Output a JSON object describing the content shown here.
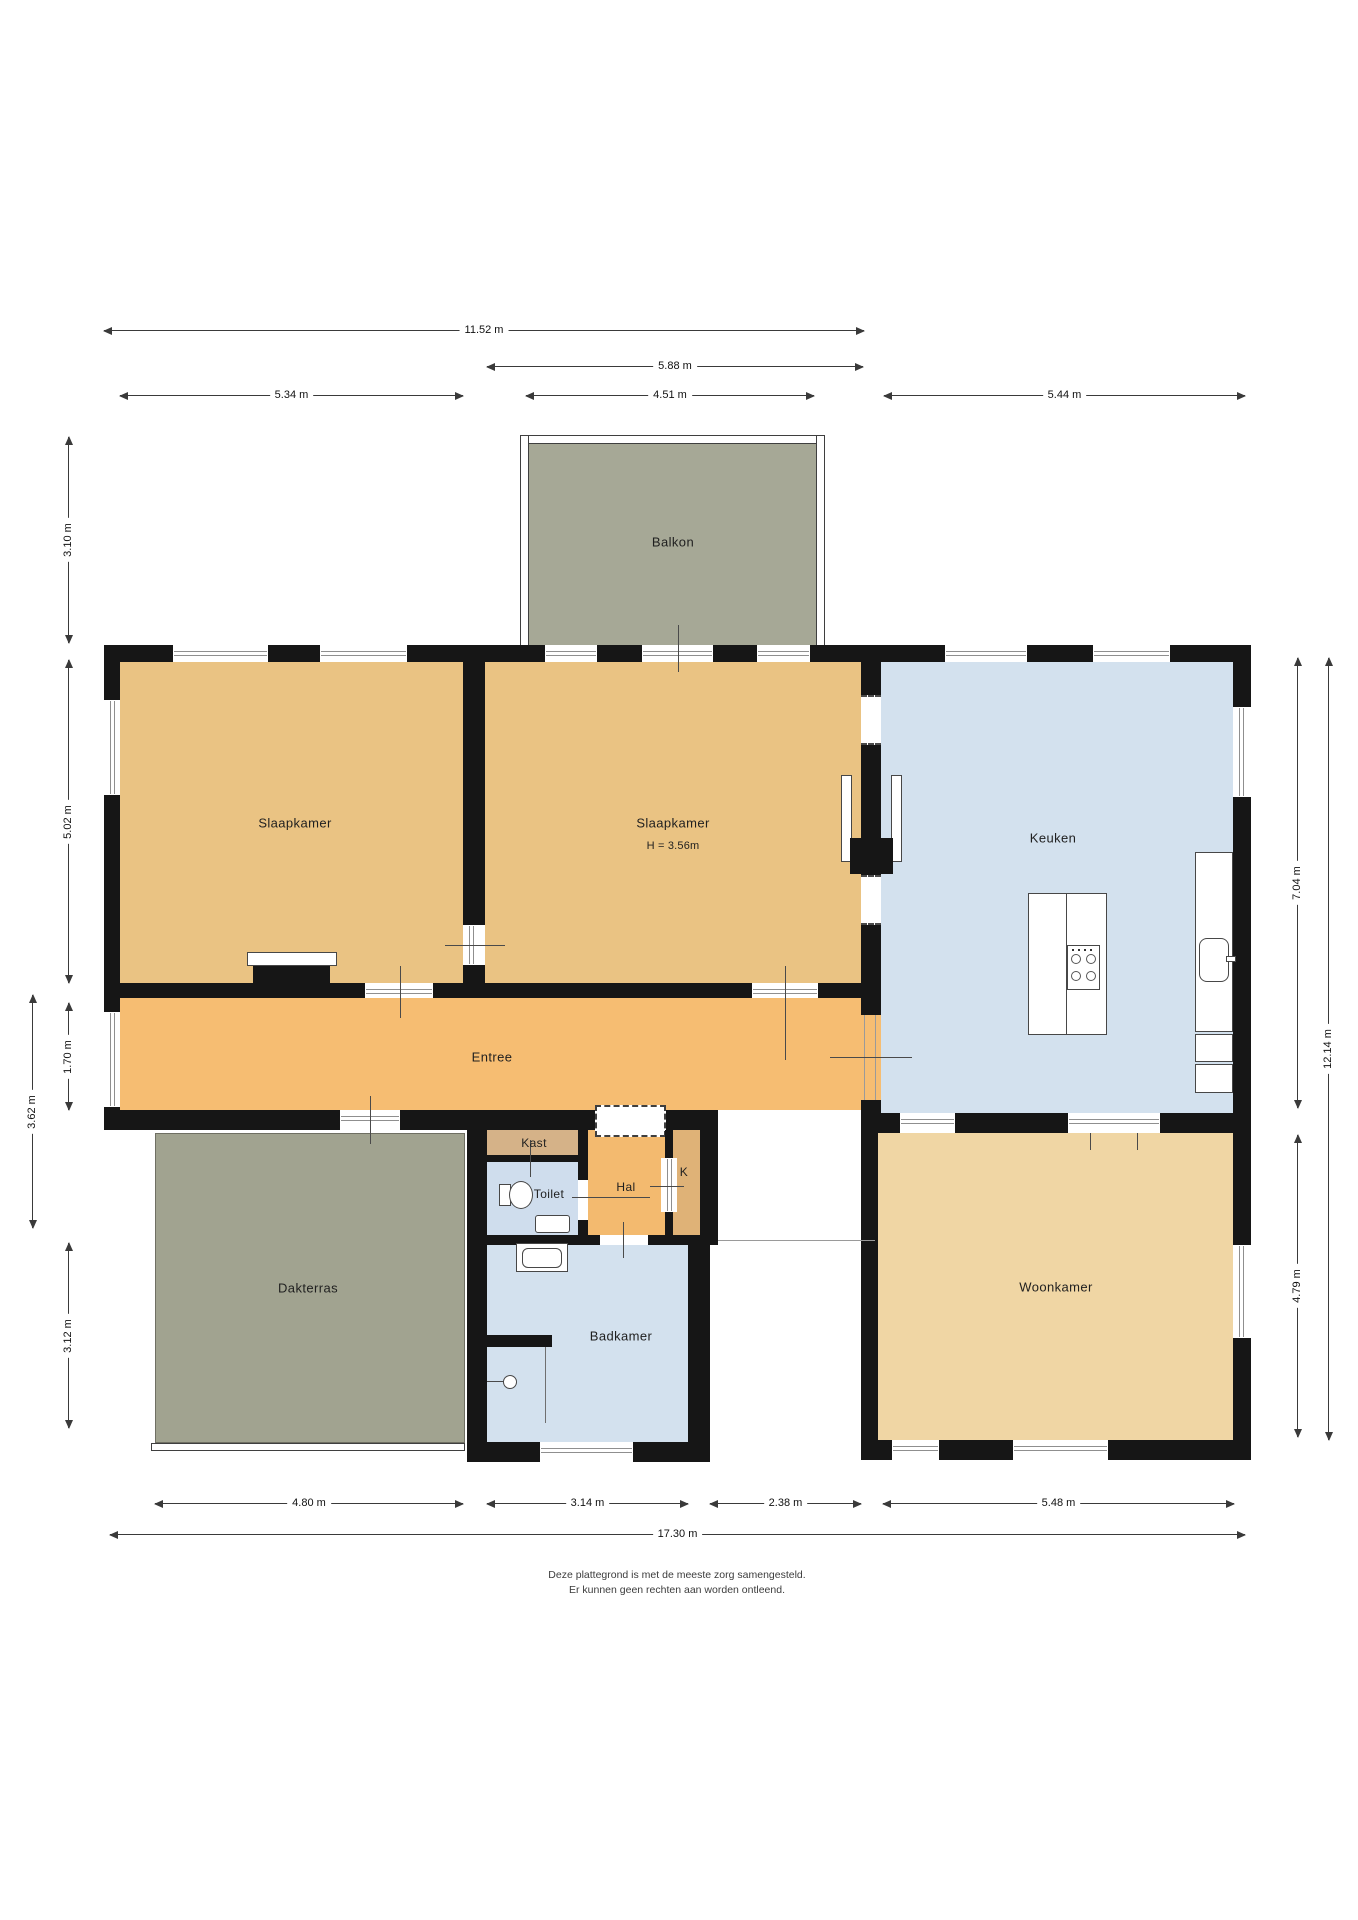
{
  "page": {
    "footer": {
      "line1": "Deze plattegrond is met de meeste zorg samengesteld.",
      "line2": "Er kunnen geen rechten aan worden ontleend."
    }
  },
  "colors": {
    "wall": "#161616",
    "window_frame": "#8f8f8f",
    "dim_line": "#3a3a3a",
    "balkon": "#a6a896",
    "dakterras": "#a1a390",
    "slaapkamer": "#eac383",
    "entree": "#f6bd72",
    "hal": "#f3ba6f",
    "kast": "#d5b288",
    "k": "#dfb277",
    "keuken": "#d3e1ee",
    "toilet": "#cfdded",
    "badkamer": "#d3e1ee",
    "woonkamer": "#f0d6a4"
  },
  "rooms": {
    "balkon": {
      "label": "Balkon"
    },
    "slaapkamer1": {
      "label": "Slaapkamer"
    },
    "slaapkamer2": {
      "label": "Slaapkamer",
      "height_note": "H = 3.56m"
    },
    "keuken": {
      "label": "Keuken"
    },
    "entree": {
      "label": "Entree"
    },
    "kast": {
      "label": "Kast"
    },
    "toilet": {
      "label": "Toilet"
    },
    "hal": {
      "label": "Hal"
    },
    "k": {
      "label": "K"
    },
    "dakterras": {
      "label": "Dakterras"
    },
    "badkamer": {
      "label": "Badkamer"
    },
    "woonkamer": {
      "label": "Woonkamer"
    }
  },
  "dimensions": {
    "top": [
      {
        "label": "11.52 m"
      },
      {
        "label": "5.88 m"
      },
      {
        "label": "5.34 m"
      },
      {
        "label": "4.51 m"
      },
      {
        "label": "5.44 m"
      }
    ],
    "left": [
      {
        "label": "3.10 m"
      },
      {
        "label": "5.02 m"
      },
      {
        "label": "1.70 m"
      },
      {
        "label": "3.62 m"
      },
      {
        "label": "3.12 m"
      }
    ],
    "right": [
      {
        "label": "7.04 m"
      },
      {
        "label": "12.14 m"
      },
      {
        "label": "4.79 m"
      }
    ],
    "bottom": [
      {
        "label": "4.80 m"
      },
      {
        "label": "3.14 m"
      },
      {
        "label": "2.38 m"
      },
      {
        "label": "5.48 m"
      },
      {
        "label": "17.30 m"
      }
    ]
  }
}
